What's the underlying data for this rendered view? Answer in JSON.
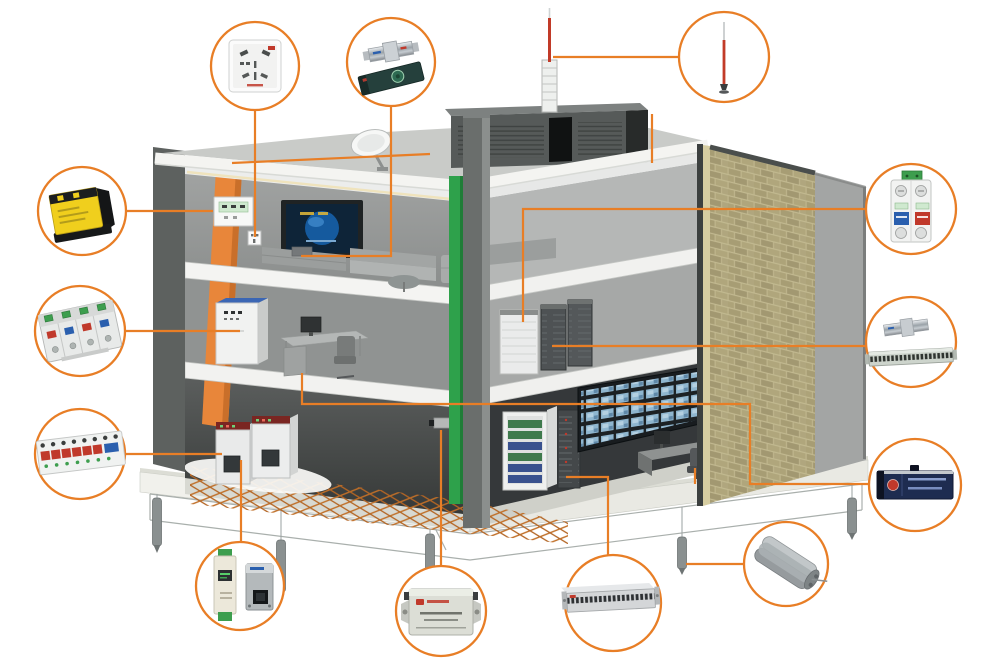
{
  "diagram": {
    "kind": "building-lightning-and-surge-protection-cutaway",
    "accent_color": "#e87e26",
    "background_color": "#ffffff",
    "colors": {
      "brick": "#aba077",
      "green_riser": "#2ea14b",
      "orange_riser": "#e8863a",
      "mesh_copper": "#c06f28",
      "spd_red": "#c0392b",
      "spd_blue": "#2a5fae",
      "spd_green": "#3d9e4e",
      "spd_yellow": "#f0cf1d",
      "navy_unit": "#1e2c50"
    },
    "building": {
      "floors": 3,
      "rooftop": [
        "lightning-rod",
        "antenna-mast",
        "penthouse",
        "satellite-dish"
      ],
      "floor3": [
        "power-panel",
        "wall-socket",
        "tv-screen",
        "av-console",
        "sofa-set"
      ],
      "floor2": [
        "distribution-cabinet",
        "office-desk-computer",
        "server-racks"
      ],
      "ground_floor": [
        "switchgear-cabinets",
        "cctv-camera",
        "dvr-rack",
        "equipment-rack",
        "cctv-monitor-wall",
        "control-desk"
      ],
      "underground": [
        "grounding-mesh",
        "ground-ring-conductor",
        "ground-electrodes"
      ],
      "risers": [
        "power-bus-riser",
        "grounding-riser"
      ],
      "facade": [
        "brick-wall",
        "cutaway-walls",
        "foundation-platform"
      ]
    },
    "callouts": [
      {
        "id": "wall-socket-spd",
        "icon": "wall-socket-icon",
        "area": "top-left",
        "points_to": "third-floor-wall-socket"
      },
      {
        "id": "coaxial-surge-arresters",
        "icon": "coax-arrester-pair-icon",
        "area": "top-center",
        "points_to": "av-console"
      },
      {
        "id": "lightning-rod",
        "icon": "lightning-rod-icon",
        "area": "top-right",
        "points_to": "rooftop-air-terminal"
      },
      {
        "id": "power-spd-class-b",
        "icon": "yellow-spd-icon",
        "area": "left-upper",
        "points_to": "third-floor-power-panel"
      },
      {
        "id": "power-spd-class-c",
        "icon": "din-rail-spd-icon",
        "area": "left-middle",
        "points_to": "second-floor-distribution-cabinet"
      },
      {
        "id": "power-spd-multi-pole",
        "icon": "din-rail-strip-spd-icon",
        "area": "left-lower",
        "points_to": "ground-floor-switchgear"
      },
      {
        "id": "power-spd-2-pole",
        "icon": "two-pole-spd-icon",
        "area": "right-upper",
        "points_to": "second-floor-server-rack-1"
      },
      {
        "id": "coax-spd-and-patch-panel",
        "icon": "coax-patch-panel-icon",
        "area": "right-middle",
        "points_to": "second-floor-server-rack-2"
      },
      {
        "id": "signal-protection-rack-unit",
        "icon": "navy-rack-unit-icon",
        "area": "right-lower",
        "points_to": "office-pc-video-wall-control-desk"
      },
      {
        "id": "grounding-module",
        "icon": "ground-electrode-module-icon",
        "area": "bottom-right",
        "points_to": "ground-electrode"
      },
      {
        "id": "signal-spd-module-pair",
        "icon": "din-module-pair-icon",
        "area": "bottom-left",
        "points_to": "ground-floor-switchgear-cabinet"
      },
      {
        "id": "video-surge-protector",
        "icon": "video-spd-box-icon",
        "area": "bottom-center-left",
        "points_to": "cctv-camera"
      },
      {
        "id": "rack-distribution-panel",
        "icon": "rack-panel-1u-icon",
        "area": "bottom-center-right",
        "points_to": "ground-floor-equipment-rack"
      }
    ]
  }
}
